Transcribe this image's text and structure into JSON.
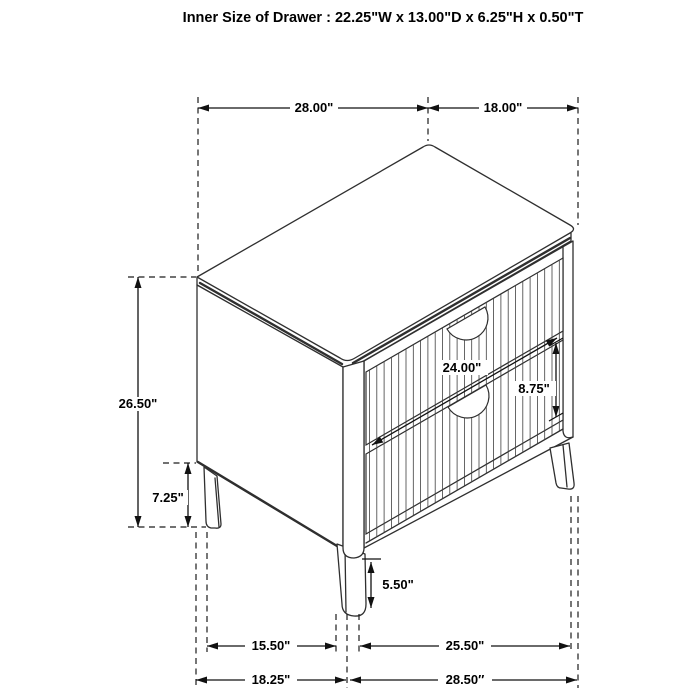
{
  "title": "Inner Size of Drawer : 22.25\"W x 13.00\"D x 6.25\"H x 0.50\"T",
  "dimensions": {
    "top_width": "28.00\"",
    "top_depth": "18.00\"",
    "overall_height": "26.50\"",
    "leg_clearance_side": "7.25\"",
    "drawer_face_width": "24.00\"",
    "drawer_face_height": "8.75\"",
    "front_leg_height": "5.50\"",
    "leg_span_side": "15.50\"",
    "leg_span_front": "25.50\"",
    "base_depth": "18.25\"",
    "base_width": "28.50″"
  },
  "colors": {
    "background": "#ffffff",
    "line_art": "#2f2f2f",
    "dimension_lines": "#111111",
    "text": "#000000"
  }
}
